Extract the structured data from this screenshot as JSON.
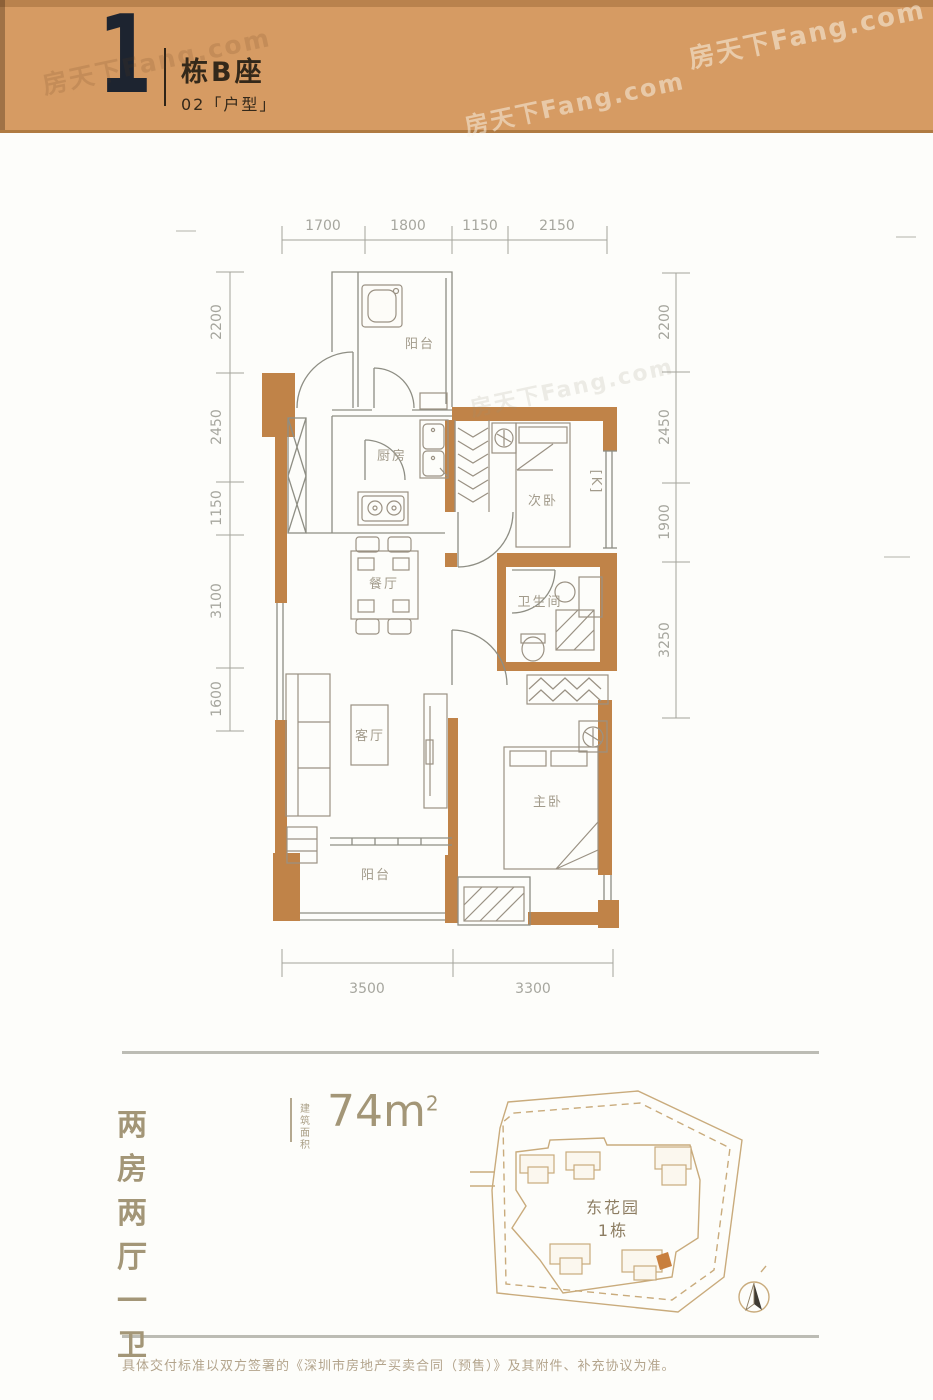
{
  "watermark": {
    "text": "房天下Fang.com"
  },
  "header": {
    "index": "1",
    "building": "栋B座",
    "unit_line": "02「户型」"
  },
  "plan": {
    "rooms": {
      "balcony_top": "阳台",
      "kitchen": "厨房",
      "bedroom2": "次卧",
      "dining": "餐厅",
      "bath": "卫生间",
      "living": "客厅",
      "master": "主卧",
      "balcony_bottom": "阳台",
      "ac_mark": "[K]"
    },
    "dims": {
      "top": [
        "1700",
        "1800",
        "1150",
        "2150"
      ],
      "left": [
        "2200",
        "2450",
        "1150",
        "3100",
        "1600"
      ],
      "right": [
        "2200",
        "2450",
        "1900",
        "3250"
      ],
      "bottom": [
        "3500",
        "3300"
      ]
    }
  },
  "summary": {
    "layout": "两房两厅一卫",
    "area_label_1": "建筑",
    "area_label_2": "面积",
    "area_value": "74m",
    "area_exp": "2"
  },
  "siteplan": {
    "title_line1": "东花园",
    "title_line2": "1栋"
  },
  "footer": {
    "disclaimer": "具体交付标准以双方签署的《深圳市房地产买卖合同（预售）》及其附件、补充协议为准。"
  },
  "colors": {
    "header_bg": "#d69b63",
    "wall": "#c08348",
    "highlight_unit": "#c87f3e",
    "dim_text": "#a6a69e"
  }
}
